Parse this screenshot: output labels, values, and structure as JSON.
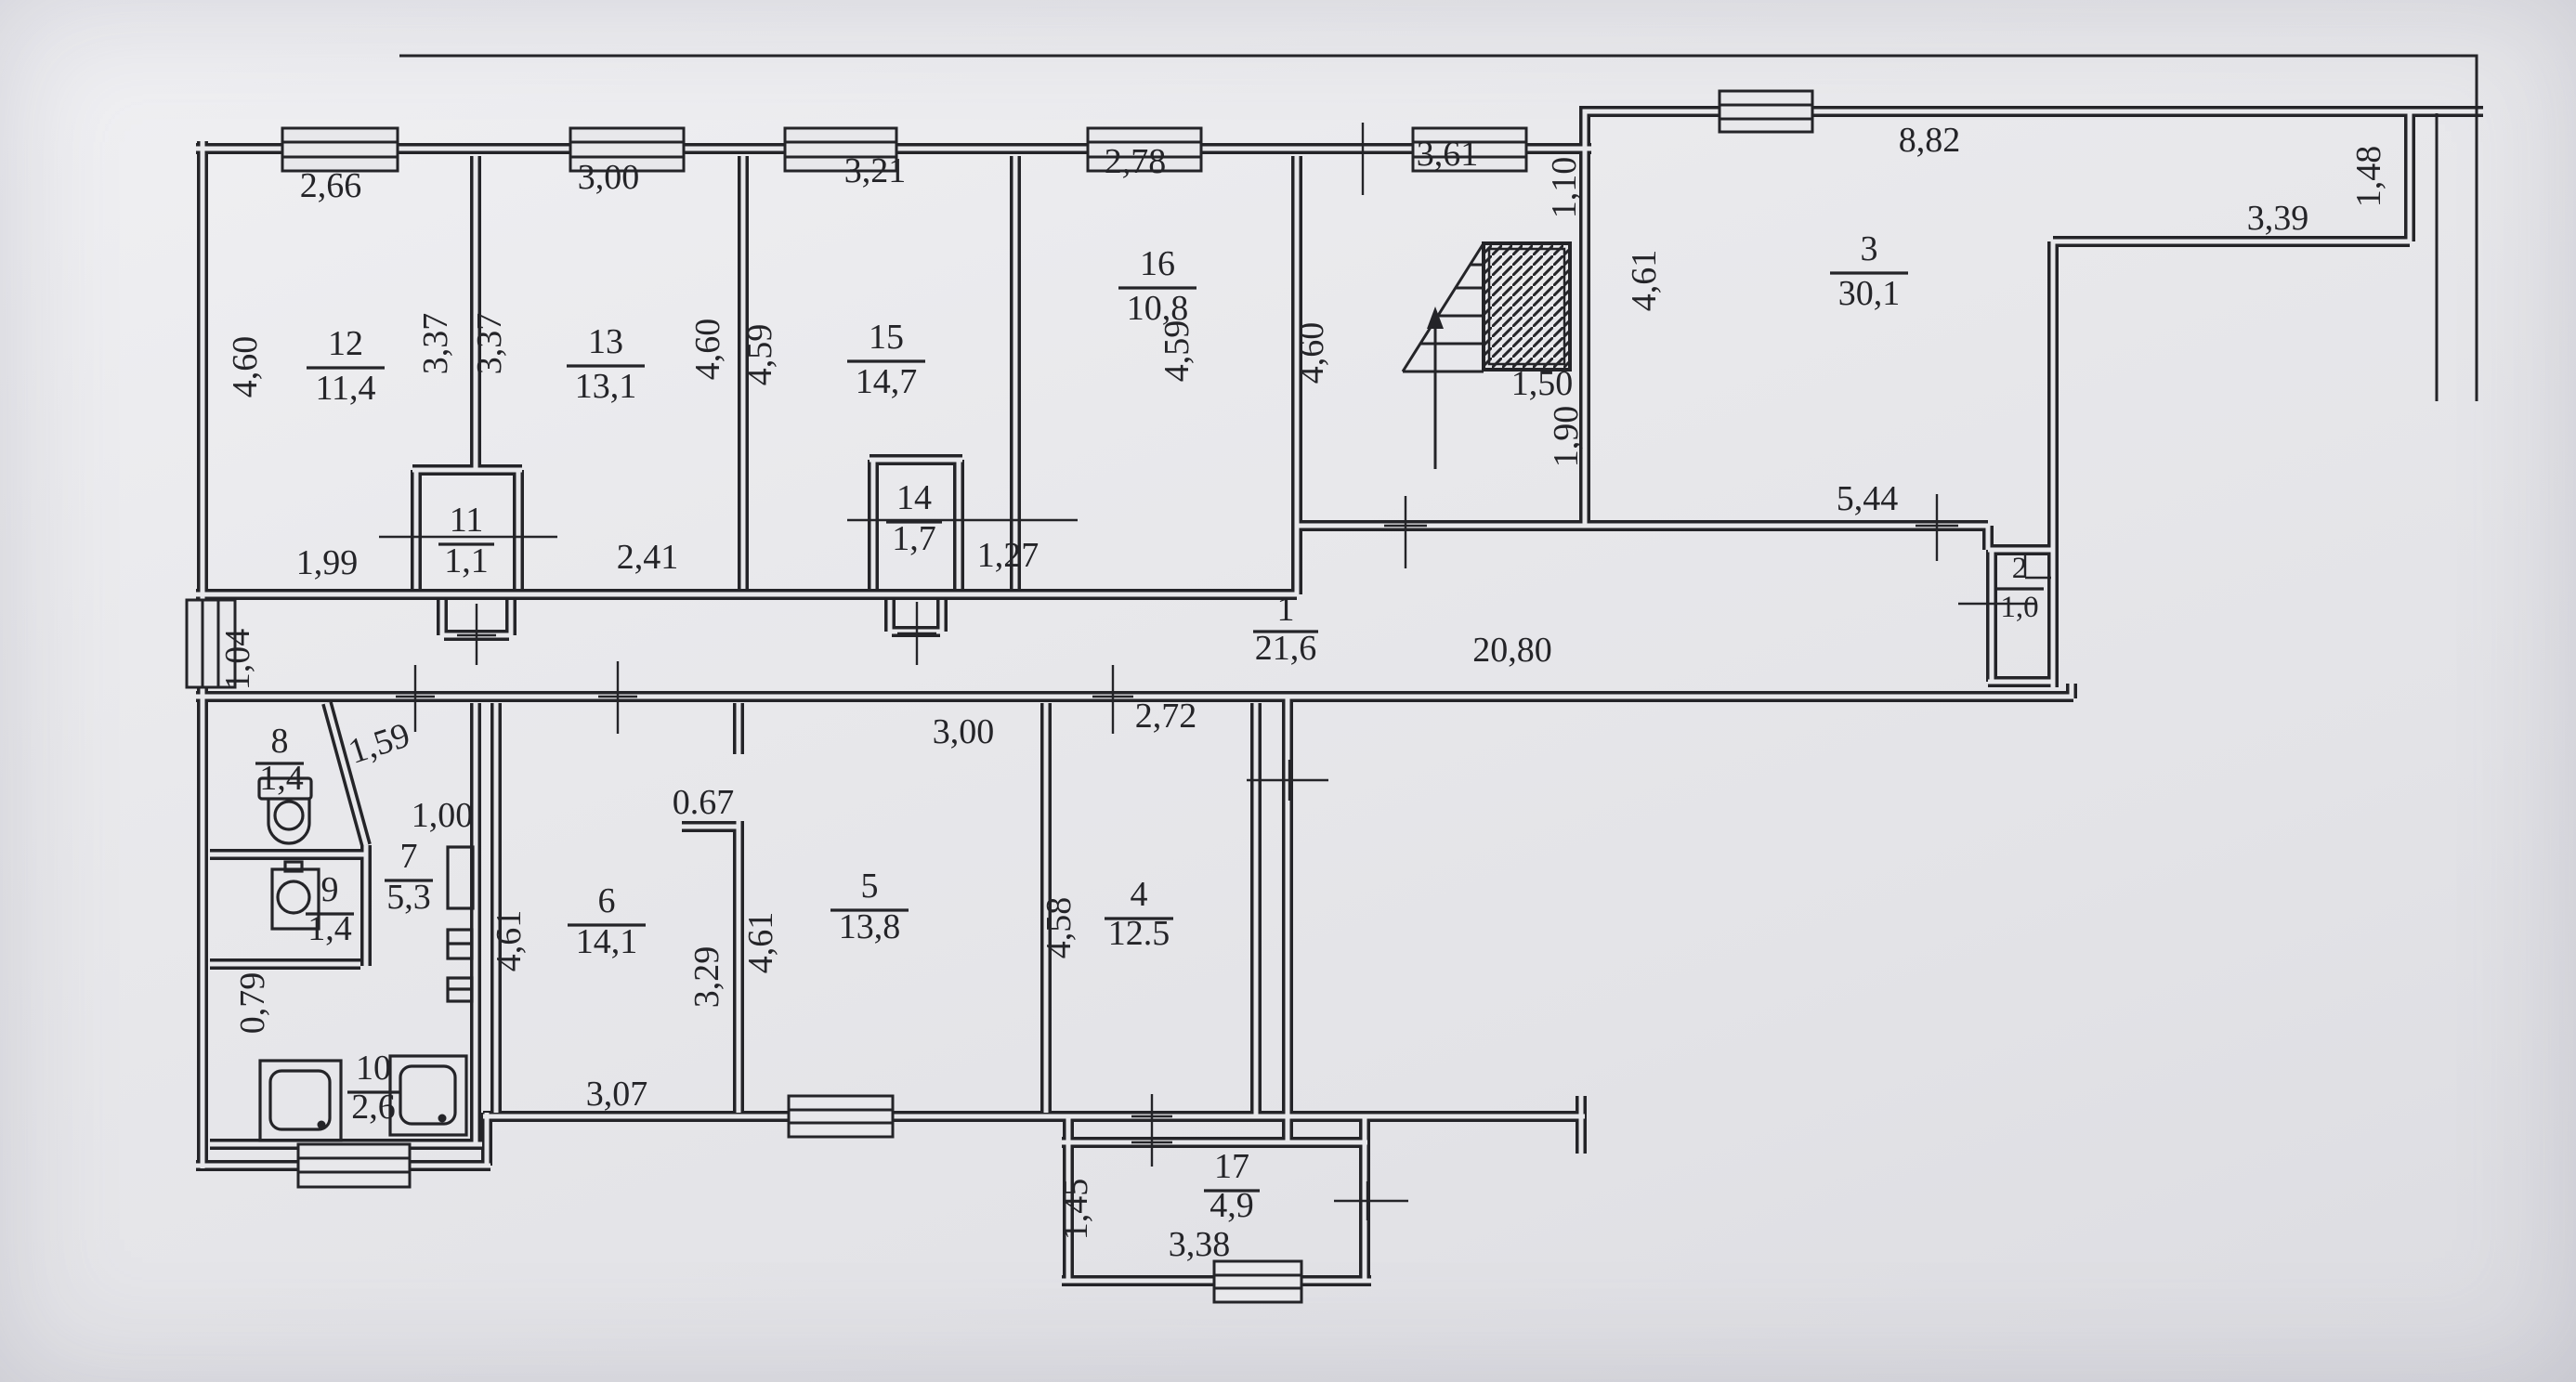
{
  "palette": {
    "paper": "#e8e8eb",
    "ink": "#242428"
  },
  "plan": {
    "rooms": {
      "r1": {
        "number": "1",
        "area": "21,6"
      },
      "r2": {
        "number": "2",
        "area": "1,0"
      },
      "r3": {
        "number": "3",
        "area": "30,1"
      },
      "r4": {
        "number": "4",
        "area": "12.5"
      },
      "r5": {
        "number": "5",
        "area": "13,8"
      },
      "r6": {
        "number": "6",
        "area": "14,1"
      },
      "r7": {
        "number": "7",
        "area": "5,3"
      },
      "r8": {
        "number": "8",
        "area": "1,4"
      },
      "r9": {
        "number": "9",
        "area": "1,4"
      },
      "r10": {
        "number": "10",
        "area": "2,6"
      },
      "r11": {
        "number": "11",
        "area": "1,1"
      },
      "r12": {
        "number": "12",
        "area": "11,4"
      },
      "r13": {
        "number": "13",
        "area": "13,1"
      },
      "r14": {
        "number": "14",
        "area": "1,7"
      },
      "r15": {
        "number": "15",
        "area": "14,7"
      },
      "r16": {
        "number": "16",
        "area": "10,8"
      },
      "r17": {
        "number": "17",
        "area": "4,9"
      }
    },
    "dims": {
      "w12_top": "2,66",
      "w13_top": "3,00",
      "w15_top": "3,21",
      "w16_top": "2,78",
      "stair_top": "3,61",
      "r3_top": "8,82",
      "r3_right_h": "1,48",
      "r3_right_w": "3,39",
      "r3_bottom": "5,44",
      "r3_left": "4,61",
      "stair_wall_upper": "1,10",
      "stair_wall_lower": "1,90",
      "stair_width": "1,50",
      "stair_left": "4,60",
      "r12_left": "4,60",
      "r12_right": "3,37",
      "r12_bottom": "1,99",
      "r13_left": "3,37",
      "r13_right": "4,60",
      "r13_bottom": "2,41",
      "r15_left": "4,59",
      "r16_side": "4,59",
      "r16_bottom": "1,27",
      "corridor_len": "20,80",
      "left_entry": "1,04",
      "r8_diag": "1,59",
      "r7_top": "1,00",
      "r10_left": "0,79",
      "r6_left": "4,61",
      "r6_right": "3,29",
      "r6_bottom": "3,07",
      "r6_niche": "0.67",
      "r5_top": "3,00",
      "r5_left": "4,61",
      "r4_top": "2,72",
      "r4_left": "4,58",
      "r17_left": "1,45",
      "r17_bottom": "3,38"
    }
  }
}
